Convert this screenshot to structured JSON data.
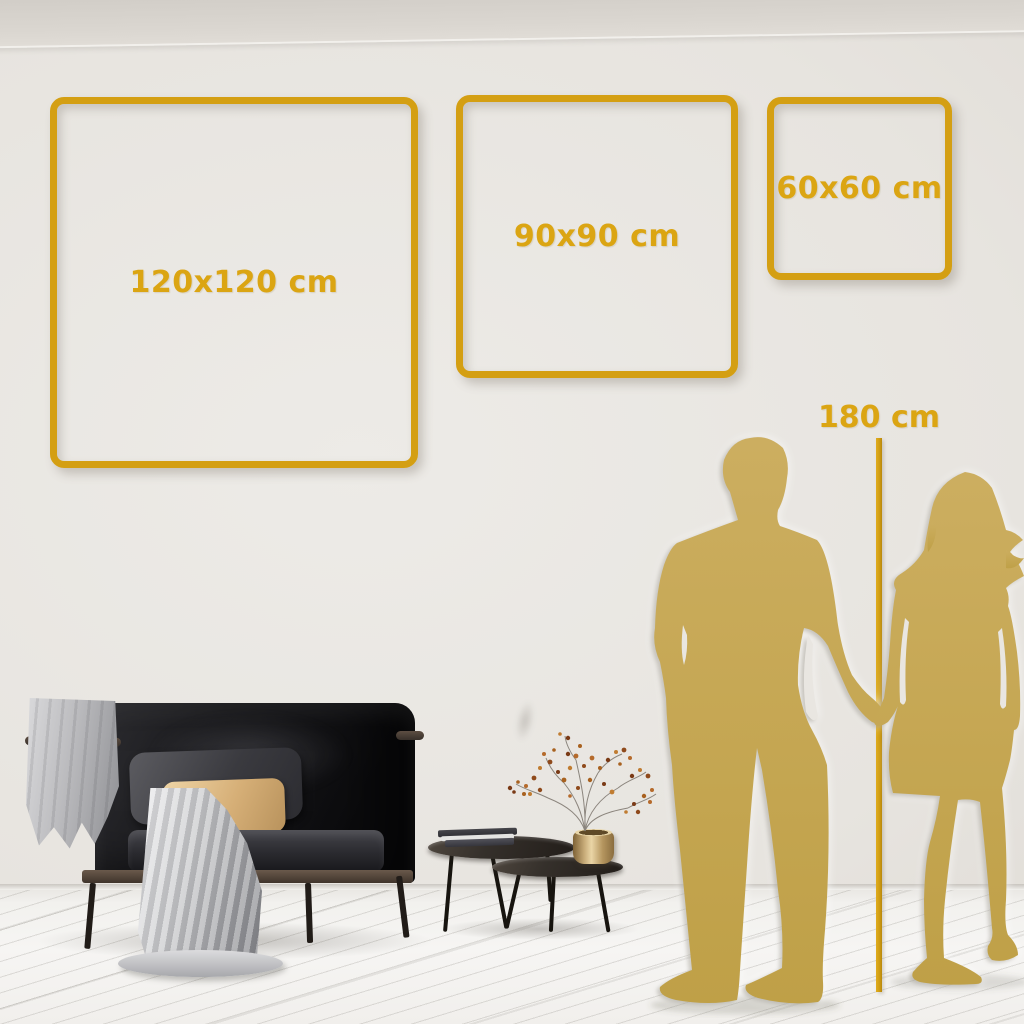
{
  "size_guide": {
    "frames": [
      {
        "id": "frame-120",
        "label": "120x120 cm"
      },
      {
        "id": "frame-90",
        "label": "90x90 cm"
      },
      {
        "id": "frame-60",
        "label": "60x60 cm"
      }
    ],
    "height_marker": {
      "label": "180 cm"
    }
  },
  "figures": {
    "man": "man-silhouette",
    "woman": "woman-silhouette"
  },
  "decor": {
    "items": [
      "sofa",
      "throw-blanket",
      "gray-pillow",
      "beige-pillow",
      "coffee-table-large",
      "coffee-table-small",
      "books",
      "brass-vase",
      "dried-plant"
    ]
  },
  "colors": {
    "frame_gold": "#d49f13",
    "label_gold": "#dba513",
    "line_gold": "#cf9c12",
    "silhouette_gold": "#c6a754",
    "wall": "#e7e4df",
    "floor": "#f3f2ef"
  }
}
